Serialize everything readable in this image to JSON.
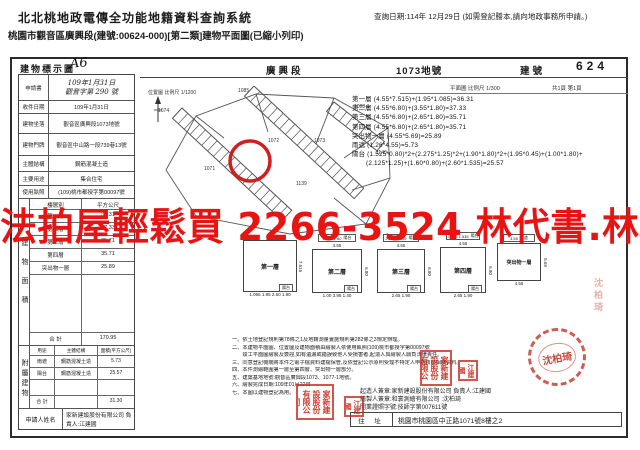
{
  "header": {
    "system_title": "北北桃地政電傳全功能地籍資料查詢系統",
    "subtitle": "桃園市觀音區廣興段(建號:00624-000)[第二類]建物平面圖(已縮小列印)",
    "query_date": "查詢日期:114年 12月29日 (如需登記謄本,請向地政事務所申請。)"
  },
  "doc": {
    "title": "建物標示圖",
    "title_annotation": "A6",
    "section_name": "廣興段",
    "parcel_no": "1073地號",
    "building_no_label": "建號",
    "building_no": "624",
    "plan_scale": "平面圖 比例尺 1/300",
    "page_info": "共1頁 第1頁"
  },
  "info_table": {
    "rows": [
      {
        "label": "申請書",
        "value": "109年1月31日",
        "value2": "觀音字第 290 號"
      },
      {
        "label": "收件日期",
        "value": "109年1月31日"
      },
      {
        "label": "建物坐落",
        "value": "觀音區廣興段1073地號"
      },
      {
        "label": "建物門牌",
        "value": "觀音區中山路一段739巷13號"
      },
      {
        "label": "主體結構",
        "value": "鋼筋混凝土造"
      },
      {
        "label": "主要用途",
        "value": "集合住宅"
      },
      {
        "label": "使用執照",
        "value": "(109)桃市都授字第00097號"
      }
    ]
  },
  "floor_table": {
    "side_label": "建物面積",
    "col1": "樓層別",
    "col2": "平方公尺",
    "rows": [
      {
        "label": "第一層",
        "value": "36.31"
      },
      {
        "label": "第二層",
        "value": "37.33"
      },
      {
        "label": "第三層",
        "value": "35.71"
      },
      {
        "label": "第四層",
        "value": "35.71"
      },
      {
        "label": "突出物一層",
        "value": "25.89"
      }
    ],
    "total_label": "合 計",
    "total": "170.95"
  },
  "annex_table": {
    "side_label": "附屬建物",
    "col1": "用途",
    "col2": "主體結構",
    "col3": "面積(平方公尺)",
    "rows": [
      {
        "use": "雨遮",
        "material": "鋼筋混凝土造",
        "area": "5.73"
      },
      {
        "use": "陽台",
        "material": "鋼筋混凝土造",
        "area": "25.57"
      }
    ],
    "total_label": "合 計",
    "total": "31.30"
  },
  "applicant": {
    "label": "申請人姓名",
    "value": "家新建設股份有限公司 負責人:江建國"
  },
  "formulas": [
    "第一層 (4.55*7.515)+(1.95*1.085)=36.31",
    "第二層 (4.55*6.80)+(3.55*1.80)=37.33",
    "第三層 (4.55*6.80)+(2.65*1.80)=35.71",
    "第四層 (4.55*6.80)+(2.65*1.80)=35.71",
    "突出物一層 (4.55*5.69)=25.89",
    "雨遮 (1.26*4.55)=5.73",
    "陽台 (1.525*0.80)*2+(2.275*1.25)*2+(1.90*1.80)*2+(1.95*0.45)+(1.00*1.80)+",
    "(2.125*1.25)+(1.60*0.80)+(2.60*1.535)=25.57"
  ],
  "map": {
    "scale_label": "位置圖 比例尺 1/1200",
    "parcels": [
      "1074",
      "1085",
      "1088-1",
      "1073",
      "1072",
      "1140",
      "1071",
      "1139"
    ]
  },
  "floorplans": [
    {
      "name": "第一層",
      "top": "4.55",
      "side": "7.515",
      "top_box": {
        "label": "",
        "dims": ""
      },
      "bottom_box": {
        "label": "陽台",
        "dims": "1.065 1.95 2.60 1.90"
      }
    },
    {
      "name": "第二層",
      "top": "4.55",
      "side": "6.80",
      "top_box": {
        "label": "陽台",
        "dims": "2.125 1.60"
      },
      "bottom_box": {
        "label": "陽台",
        "dims": "1.00 3.95 1.40"
      }
    },
    {
      "name": "第三層",
      "top": "4.55",
      "side": "6.80",
      "top_box": {
        "label": "陽台",
        "dims": "2.275 1.535"
      },
      "bottom_box": {
        "label": "陽台",
        "dims": "2.65 1.90"
      }
    },
    {
      "name": "第四層",
      "top": "4.55",
      "side": "6.80",
      "top_box": {
        "label": "陽台",
        "dims": "2.275 1.535"
      },
      "bottom_box": {
        "label": "陽台",
        "dims": "2.65 1.90"
      }
    },
    {
      "name": "突出物一層",
      "top": "",
      "side": "5.69",
      "top_box": {
        "label": "雨遮",
        "dims": "4.55"
      },
      "bottom_box": {
        "label": "",
        "dims": "4.55"
      }
    }
  ],
  "notes": [
    "一、依土地登記規則第78條之1及地籍測量實施規則第282條之3規定辦理。",
    "二、本建物平面圖、位置圖及建物面積由繪製人依使用執照(109)桃市都授字第00097號",
    "　　竣工平面圖繪製及簽證,如有遺漏或錯誤致他人受損害者,起造人與繪製人願負法律責任。",
    "三、同意登記機關將本件之電子檔資料建檔保管,及依登記公示原則受理不特定人申請核發相關資料。",
    "四、本件測繪範圍第一層至第四層、突出物一層部分。",
    "五、建築基地地號:觀音區廣興段1073、1077-1地號。",
    "六、繪製完成日期:109年01月22日",
    "七、本圖以建物登記為用。"
  ],
  "signers": {
    "line1": "起造人簽章:家新建設股份有限公司 負責人:江建國",
    "line2": "繪製人簽章:和寰測繪有限公司 :沈柏琦",
    "line3": "開業證照字號:技師字第007611號",
    "address_label": "住 址",
    "address": "桃園市桃園區中正路1071號8樓之2"
  },
  "stamps": {
    "company_seal": "家新建設股份有限公司",
    "person_seal": "江建國",
    "round_seal": "沈柏琦",
    "side_seal": "沈柏琦"
  },
  "watermark": {
    "text": "法拍屋輕鬆買 2266-3524 林代書.林經理",
    "color": "#e81414"
  }
}
